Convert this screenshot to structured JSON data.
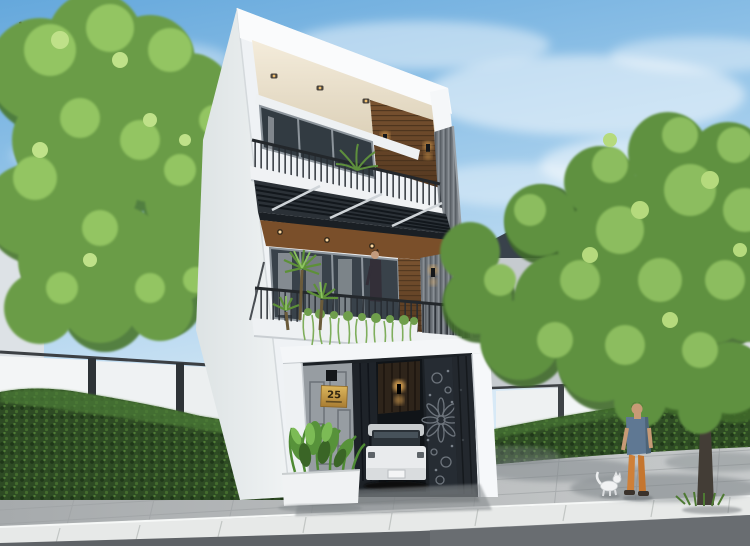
{
  "meta": {
    "title": "Modern three-storey townhouse street rendering",
    "type": "3d-architectural-visualization",
    "canvas": {
      "width": 750,
      "height": 546
    }
  },
  "house": {
    "number_plate": "25",
    "number_plate_subtext_visible": true,
    "storeys": 3,
    "garage": true,
    "features": [
      "white cantilevered parapet with recessed downlight ceiling",
      "dark wood slat accent walls with sconce lights",
      "black metal balcony railings",
      "louvred pergola canopy over second floor",
      "white planter box with trailing vines",
      "palm plants on balcony",
      "laser-cut floral garage gate",
      "grey vertical slat cladding column",
      "white SUV parked in garage",
      "woman standing on second-floor balcony"
    ]
  },
  "street": {
    "sidewalk": "grey paver sidewalk",
    "curb": "white curb stones",
    "road": "asphalt road",
    "street_tree": true,
    "boundary": "white fence panels with green hedge",
    "pedestrian": "man in blue t-shirt and orange trousers",
    "dog": "small white dog"
  },
  "palette": {
    "sky_top": "#6cadde",
    "sky_horizon": "#d7e9f6",
    "cloud": "#ffffff",
    "wall_white": "#f3f5f7",
    "soffit_warm": "#eadfc6",
    "wood_brown": "#6b4527",
    "glass_dark": "#39424a",
    "cladding_grey": "#70767c",
    "railing_dark": "#24282c",
    "pergola_slat": "#2b3137",
    "gate_charcoal": "#262c33",
    "plaque_gold": "#c9a03f",
    "glow_warm": "#f7b85c",
    "foliage_mid": "#6a9c47",
    "foliage_light": "#93c562",
    "foliage_dark": "#49772f",
    "hedge_dark": "#2e4b24",
    "fence_white": "#f3f5f6",
    "pavement_grey": "#b4b8ba",
    "curb_white": "#e7e9e8",
    "road_grey": "#5e6266",
    "car_white": "#e9ebed",
    "shirt_blue": "#5f7893",
    "pants_orange": "#cf8038",
    "bg_building_dark": "#39424b",
    "bg_building_grey": "#c6cbcf"
  }
}
